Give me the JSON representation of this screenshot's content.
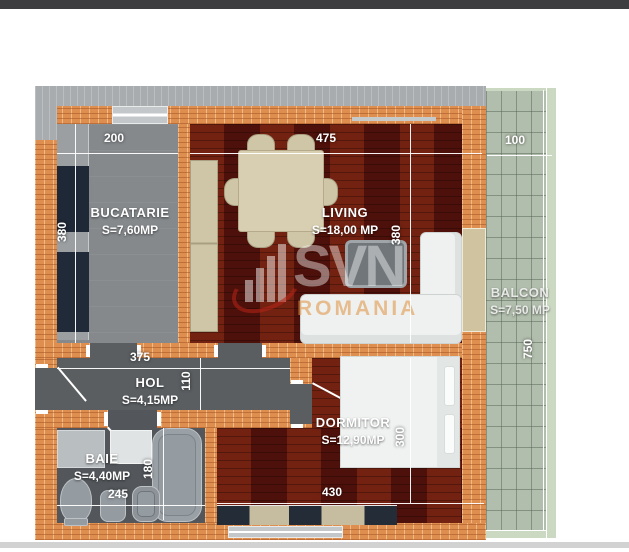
{
  "watermark": {
    "brand": "SVN",
    "region": "ROMANIA"
  },
  "rooms": {
    "bucatarie": {
      "name": "BUCATARIE",
      "area": "S=7,60MP"
    },
    "living": {
      "name": "LIVING",
      "area": "S=18,00 MP"
    },
    "balcon": {
      "name": "BALCON",
      "area": "S=7,50 MP"
    },
    "hol": {
      "name": "HOL",
      "area": "S=4,15MP"
    },
    "baie": {
      "name": "BAIE",
      "area": "S=4,40MP"
    },
    "dormitor": {
      "name": "DORMITOR",
      "area": "S=12,90MP"
    }
  },
  "dimensions": {
    "bucatarie_w": "200",
    "bucatarie_h": "380",
    "living_w": "475",
    "living_h": "380",
    "balcon_w": "100",
    "balcon_len": "750",
    "hol_w": "375",
    "hol_h": "110",
    "baie_w": "245",
    "baie_h": "180",
    "dormitor_w": "430",
    "dormitor_h": "300"
  }
}
